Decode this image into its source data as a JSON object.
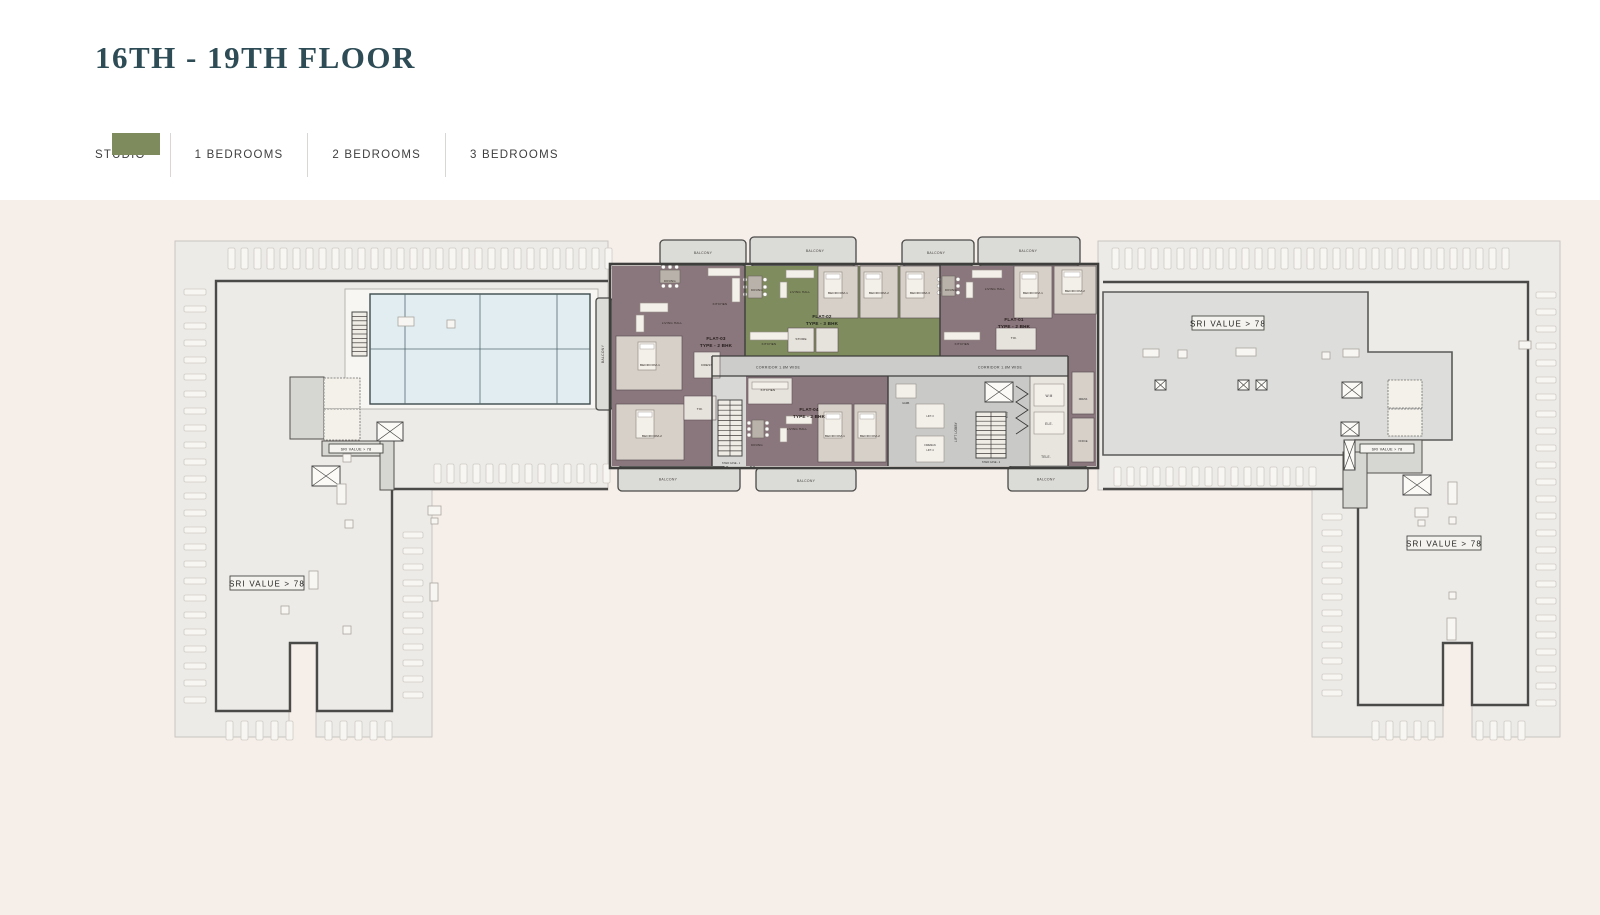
{
  "page": {
    "title": "16TH - 19TH FLOOR"
  },
  "legend": {
    "items": [
      {
        "label": "STUDIO",
        "color": "#92a6ac"
      },
      {
        "label": "1 BEDROOMS",
        "color": "#c7bda4"
      },
      {
        "label": "2 BEDROOMS",
        "color": "#8a757c"
      },
      {
        "label": "3 BEDROOMS",
        "color": "#7e8b5c"
      }
    ]
  },
  "plan": {
    "flats": [
      {
        "name": "FLAT-01",
        "type": "TYPE - 2 BHK",
        "color": "#8a767d"
      },
      {
        "name": "FLAT-02",
        "type": "TYPE - 3 BHK",
        "color": "#7f8c5e"
      },
      {
        "name": "FLAT-03",
        "type": "TYPE - 2 BHK",
        "color": "#8a767d"
      },
      {
        "name": "FLAT-04",
        "type": "TYPE - 2 BHK",
        "color": "#8a767d"
      }
    ],
    "labels": {
      "sri_value": "SRI VALUE > 78",
      "corridor": "CORRIDOR 1.8M WIDE",
      "balcony": "BALCONY",
      "lift_lobby": "LIFT LOBBY",
      "stair_case_1": "STAIR CASE - 1",
      "stair_case_2": "STAIR CASE - 2",
      "lift_3": "LIFT-3",
      "fireman": "FIREMAN",
      "lift_4": "LIFT-4",
      "wm": "W.M",
      "ele": "ELE.",
      "tele": "TELE.",
      "garb": "GARB.",
      "btu": "B.T.U",
      "dress": "DRESS",
      "office": "OFFICE"
    },
    "rooms": {
      "dining": "DINING",
      "living_hall": "LIVING HALL",
      "kitchen": "KITCHEN",
      "bedroom1": "BEDROOM-1",
      "bedroom2": "BEDROOM-2",
      "bedroom3": "BEDROOM-3",
      "toi": "TOI.",
      "store": "STORE",
      "dress": "DRESS"
    }
  }
}
